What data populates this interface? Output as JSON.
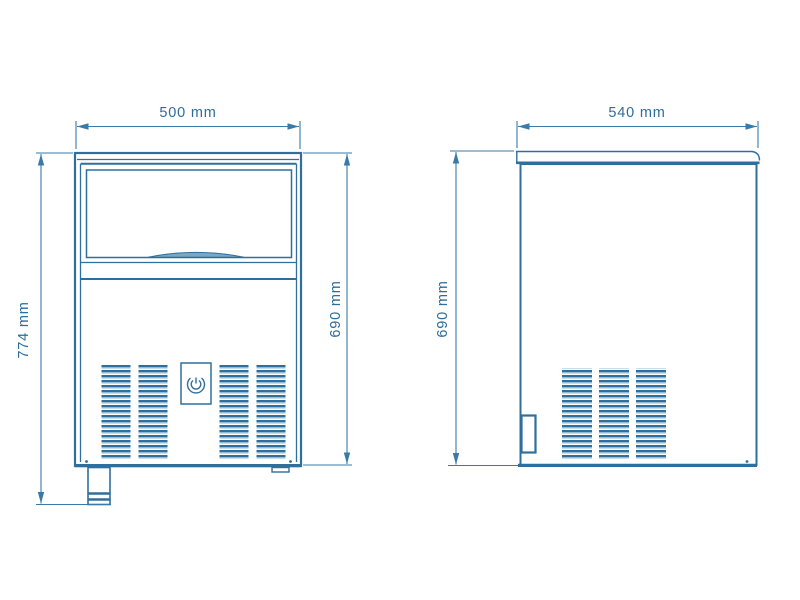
{
  "front": {
    "width_label": "500 mm",
    "total_height_label": "774 mm",
    "body_height_label": "690 mm"
  },
  "side": {
    "depth_label": "540 mm",
    "height_label": "690 mm"
  },
  "colors": {
    "line": "#2f6f9d",
    "dimension_line": "#3a7aa8",
    "label_text": "#2b6d9c",
    "vent_slat_fill": "#93bbd5",
    "handle_fill": "#7aa7c6",
    "background": "#ffffff"
  },
  "icons": {
    "logo_badge": "brand-emblem-icon",
    "arrowhead": "dimension-arrowhead-icon"
  }
}
